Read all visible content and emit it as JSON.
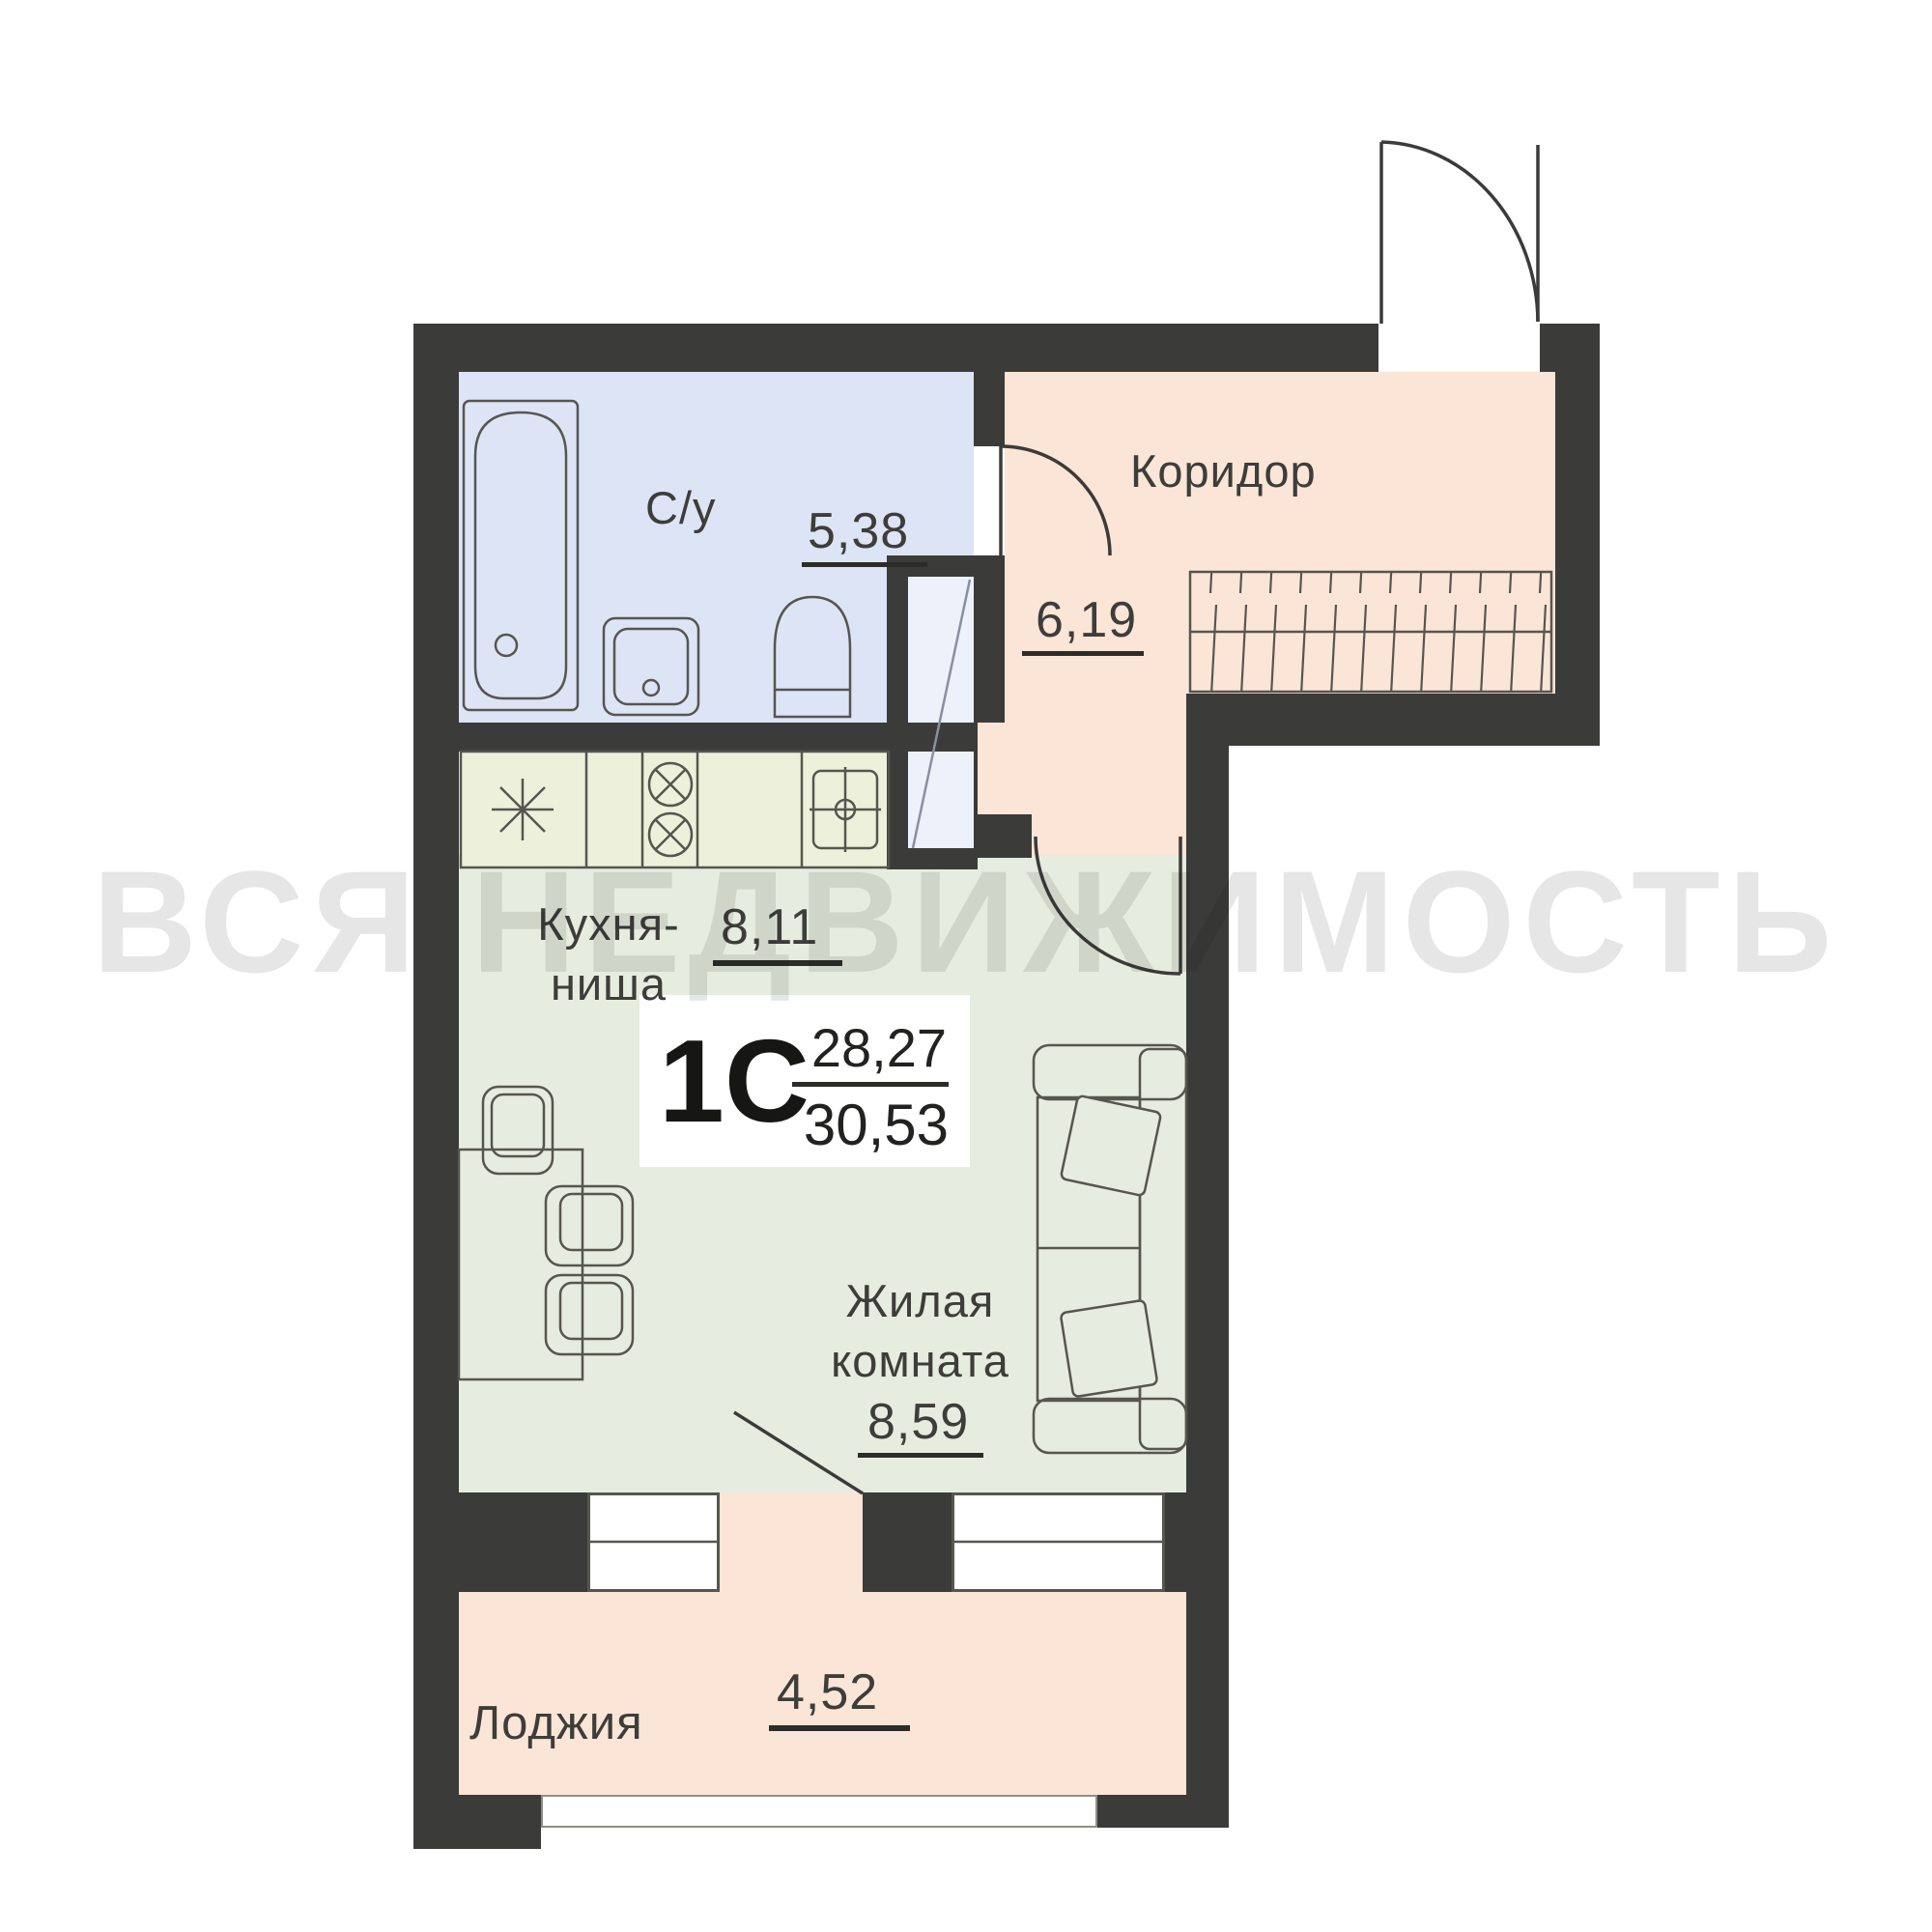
{
  "watermark_text": "ВСЯ НЕДВИЖИМОСТЬ",
  "unit": {
    "type_label": "1С",
    "area_upper": "28,27",
    "area_lower": "30,53"
  },
  "rooms": {
    "bathroom": {
      "label": "С/у",
      "area": "5,38"
    },
    "corridor": {
      "label": "Коридор",
      "area": "6,19"
    },
    "kitchen": {
      "label_line1": "Кухня-",
      "label_line2": "ниша",
      "area": "8,11"
    },
    "living": {
      "label_line1": "Жилая",
      "label_line2": "комната",
      "area": "8,59"
    },
    "loggia": {
      "label": "Лоджия",
      "area": "4,52"
    }
  },
  "colors": {
    "wall": "#3b3b39",
    "line": "#56564f",
    "bath": "#dde4f5",
    "peach": "#fae5d7",
    "green": "#e6ecdf",
    "counter": "#edf1dc",
    "shaft": "#edf1fa",
    "text": "#3d3d3a",
    "uline": "#2c2c2a",
    "wm": "#d6d6d6"
  },
  "furniture_icons": [
    "bathtub-icon",
    "washbasin-icon",
    "toilet-icon",
    "fridge-asterisk-icon",
    "cooktop-burners-icon",
    "kitchen-sink-icon",
    "ventilation-shaft-icon",
    "wardrobe-hatch-icon",
    "dining-table-icon",
    "chair-icon",
    "sofa-icon",
    "pillow-icon",
    "entrance-door-arc-icon",
    "bathroom-door-arc-icon",
    "room-door-arc-icon",
    "balcony-door-leaf-icon",
    "window-icon"
  ]
}
